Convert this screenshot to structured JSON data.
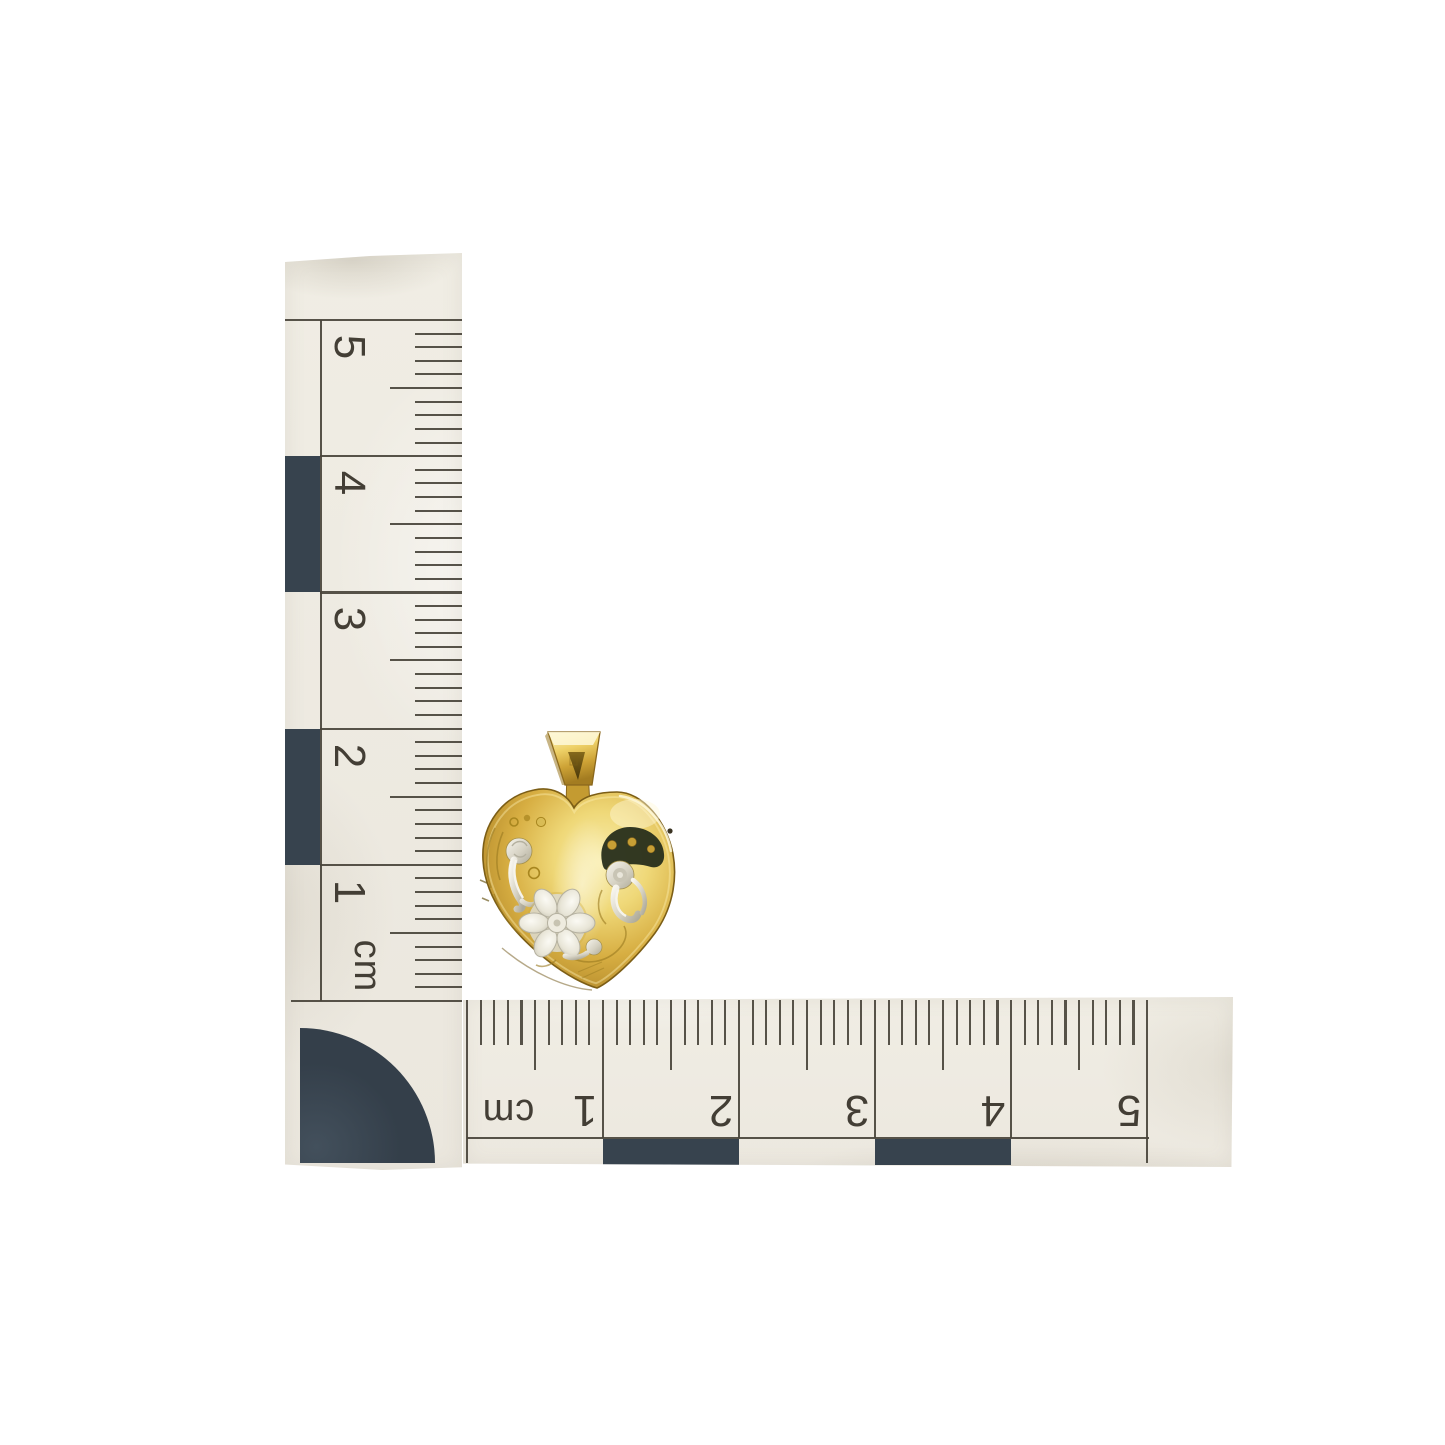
{
  "scene": {
    "background_color": "#ffffff",
    "subject": "yellow-gold heart locket pendant photographed with two centimetre rulers arranged in an L-shape for scale"
  },
  "rulers": {
    "vertical": {
      "unit_label": "cm",
      "numbers": [
        "5",
        "4",
        "3",
        "2",
        "1"
      ],
      "cm_count": 5,
      "ticks_per_cm": 10,
      "dark_checker_segments": [
        1,
        3
      ]
    },
    "horizontal": {
      "unit_label": "cm",
      "numbers": [
        "1",
        "2",
        "3",
        "4",
        "5"
      ],
      "cm_count": 5,
      "ticks_per_cm": 10,
      "dark_checker_segments": [
        1,
        3
      ]
    }
  },
  "pendant": {
    "type": "heart-locket",
    "approx_width_cm": 1.4,
    "approx_height_cm": 1.45,
    "features": [
      "trapezoid bail",
      "engraved silver scrolls",
      "engraved flower",
      "dark patina patch with gold dots"
    ]
  },
  "colors": {
    "paper": "#efece3",
    "ink": "#49443b",
    "checker": "#37434e",
    "numerals": "#433e35",
    "gold_highlight": "#f9eeb0",
    "gold_mid": "#d7ae42",
    "gold_shadow": "#8a671c",
    "silver_light": "#f6f4ec",
    "silver_mid": "#d9d5c7",
    "silver_shadow": "#aeaa99",
    "patina_dark": "#272e1b"
  }
}
